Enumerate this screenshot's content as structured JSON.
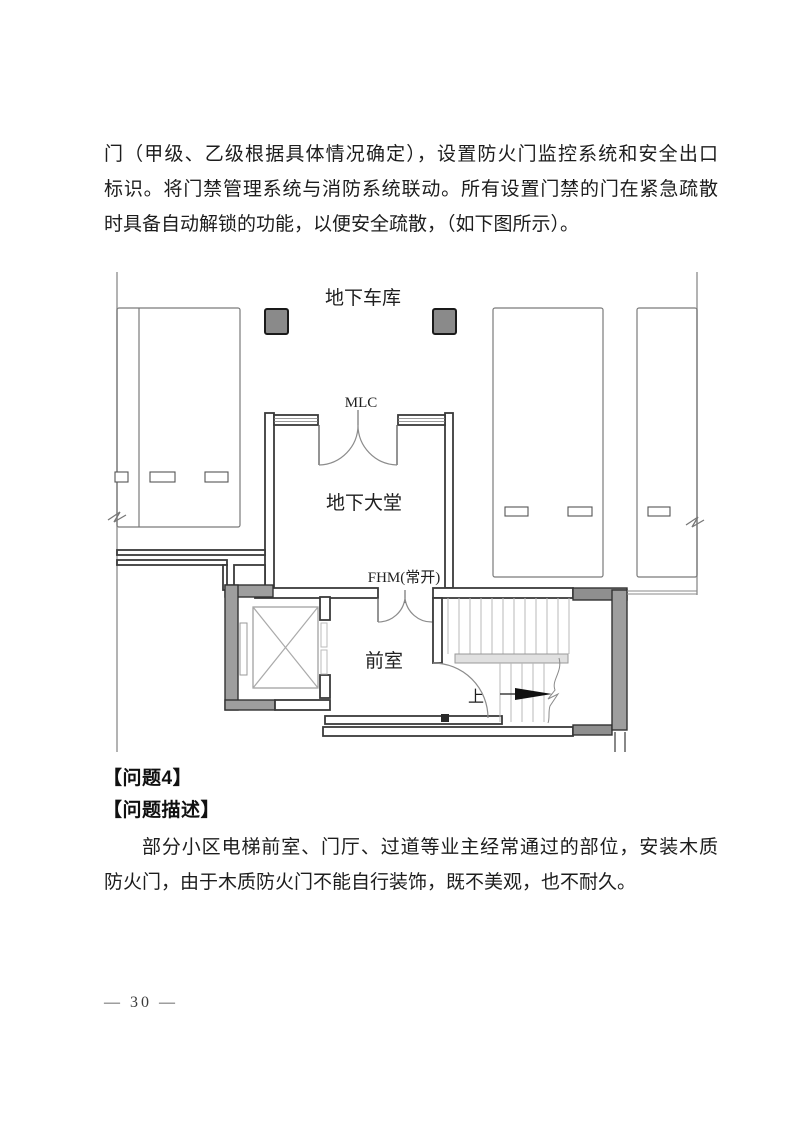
{
  "document": {
    "paragraph_top_lines": [
      "门（甲级、乙级根据具体情况确定），设置防火门监控系统和安全出口",
      "标识。将门禁管理系统与消防系统联动。所有设置门禁的门在紧急疏散",
      "时具备自动解锁的功能，以便安全疏散，（如下图所示）。"
    ],
    "heading_problem": "【问题4】",
    "heading_description": "【问题描述】",
    "paragraph_bottom_lines": [
      "部分小区电梯前室、门厅、过道等业主经常通过的部位，安装木质",
      "防火门，由于木质防火门不能自行装饰，既不美观，也不耐久。"
    ],
    "footer_page": "— 30 —"
  },
  "floorplan": {
    "garage_label": "地下车库",
    "mlc_label": "MLC",
    "lobby_label": "地下大堂",
    "fhm_label": "FHM(常开)",
    "front_room_label": "前室",
    "up_label": "上",
    "colors": {
      "wall_line": "#3a3a3a",
      "column_fill": "#8a8a8a",
      "shaft_fill": "#9e9e9e",
      "landing_fill": "#e0e0e0",
      "text": "#1f1f1f"
    }
  }
}
